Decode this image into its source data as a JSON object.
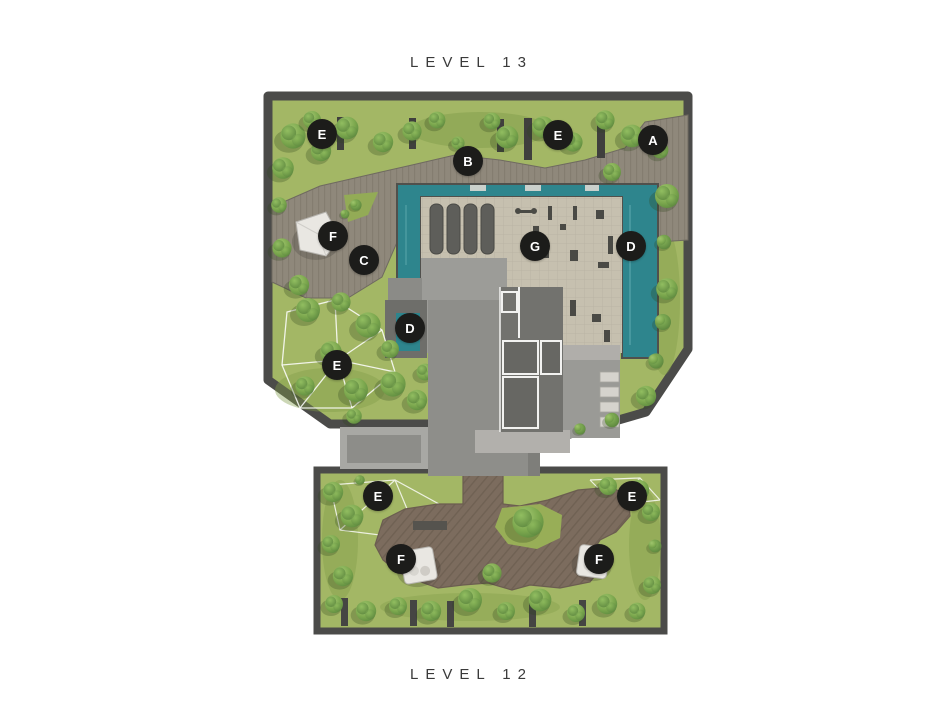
{
  "page": {
    "background": "#ffffff"
  },
  "plans": {
    "level13": {
      "title": "LEVEL 13",
      "markers": [
        {
          "label": "E",
          "x": 322,
          "y": 134
        },
        {
          "label": "B",
          "x": 468,
          "y": 161
        },
        {
          "label": "E",
          "x": 558,
          "y": 135
        },
        {
          "label": "A",
          "x": 653,
          "y": 140
        },
        {
          "label": "F",
          "x": 333,
          "y": 236
        },
        {
          "label": "C",
          "x": 364,
          "y": 260
        },
        {
          "label": "G",
          "x": 535,
          "y": 246
        },
        {
          "label": "D",
          "x": 631,
          "y": 246
        },
        {
          "label": "D",
          "x": 410,
          "y": 328
        },
        {
          "label": "E",
          "x": 337,
          "y": 365
        }
      ]
    },
    "level12": {
      "title": "LEVEL 12",
      "markers": [
        {
          "label": "E",
          "x": 378,
          "y": 496
        },
        {
          "label": "E",
          "x": 632,
          "y": 496
        },
        {
          "label": "F",
          "x": 401,
          "y": 559
        },
        {
          "label": "F",
          "x": 599,
          "y": 559
        }
      ]
    }
  },
  "palette": {
    "marker_bg": "#1c1c1a",
    "marker_text": "#ffffff",
    "title_text": "#3a3a3a",
    "pool_water": "#2e858d",
    "grass": "#a3b765",
    "tree_green": "#6f9a42",
    "deck_level13": "#8f887b",
    "deck_level12": "#7c6c5e",
    "gym_floor": "#c6c0af",
    "tower_gray": "#8e8e8a",
    "boundary_wall": "#4b4b49"
  }
}
